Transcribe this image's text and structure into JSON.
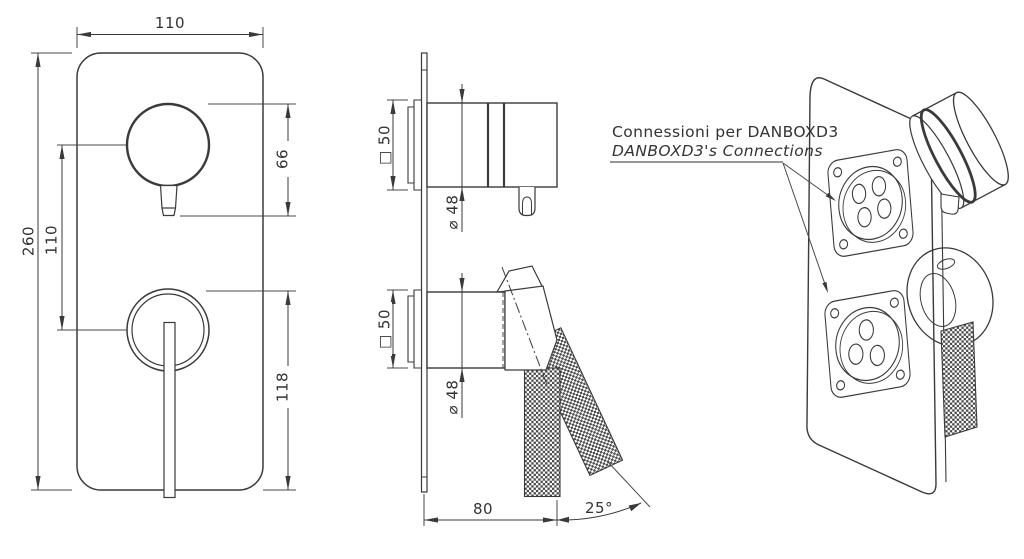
{
  "front_view": {
    "width": "110",
    "height": "260",
    "handle_center_spacing": "110",
    "top_handle_height": "66",
    "bottom_lever_height": "118"
  },
  "side_view": {
    "top_box_size": "□ 50",
    "top_knob_diameter": "⌀ 48",
    "bottom_box_size": "□ 50",
    "bottom_knob_diameter": "⌀ 48",
    "projection_depth": "80",
    "lever_swing_angle": "25°"
  },
  "annotation": {
    "line1": "Connessioni per DANBOXD3",
    "line2": "DANBOXD3's Connections"
  },
  "colors": {
    "line": "#3a3a3a",
    "dim_line": "#4a4a4a",
    "knurl": "#4a4a4a",
    "background": "#ffffff",
    "text": "#333333"
  }
}
